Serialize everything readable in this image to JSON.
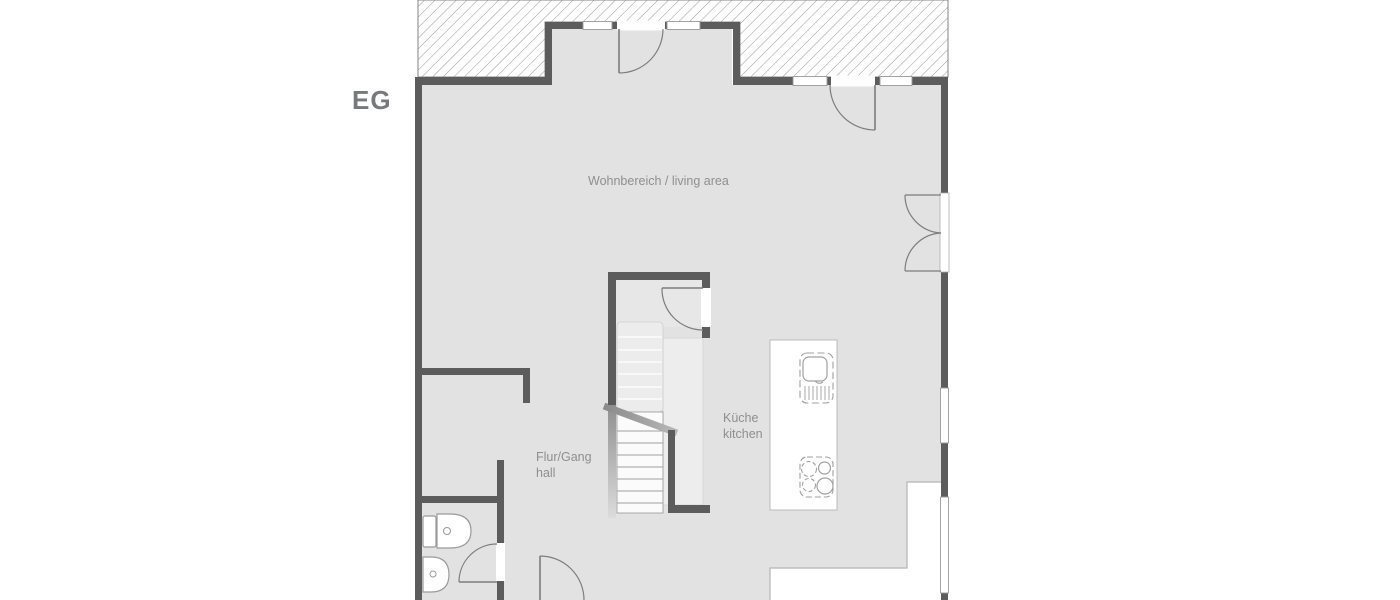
{
  "plan": {
    "floor_label": "EG",
    "labels": {
      "living_area": "Wohnbereich / living area",
      "kitchen_line1": "Küche",
      "kitchen_line2": "kitchen",
      "hall_line1": "Flur/Gang",
      "hall_line2": "hall"
    },
    "rooms": [
      {
        "name": "Wohnbereich / living area"
      },
      {
        "name": "Küche / kitchen"
      },
      {
        "name": "Flur/Gang / hall"
      }
    ],
    "colors": {
      "background": "#ffffff",
      "floor": "#e2e2e2",
      "wall": "#5c5c5c",
      "hatch_line": "#9a9a9a",
      "label_text": "#8f8f8f",
      "floor_label_text": "#77797c",
      "symbol_line": "#9a9a9a"
    }
  }
}
